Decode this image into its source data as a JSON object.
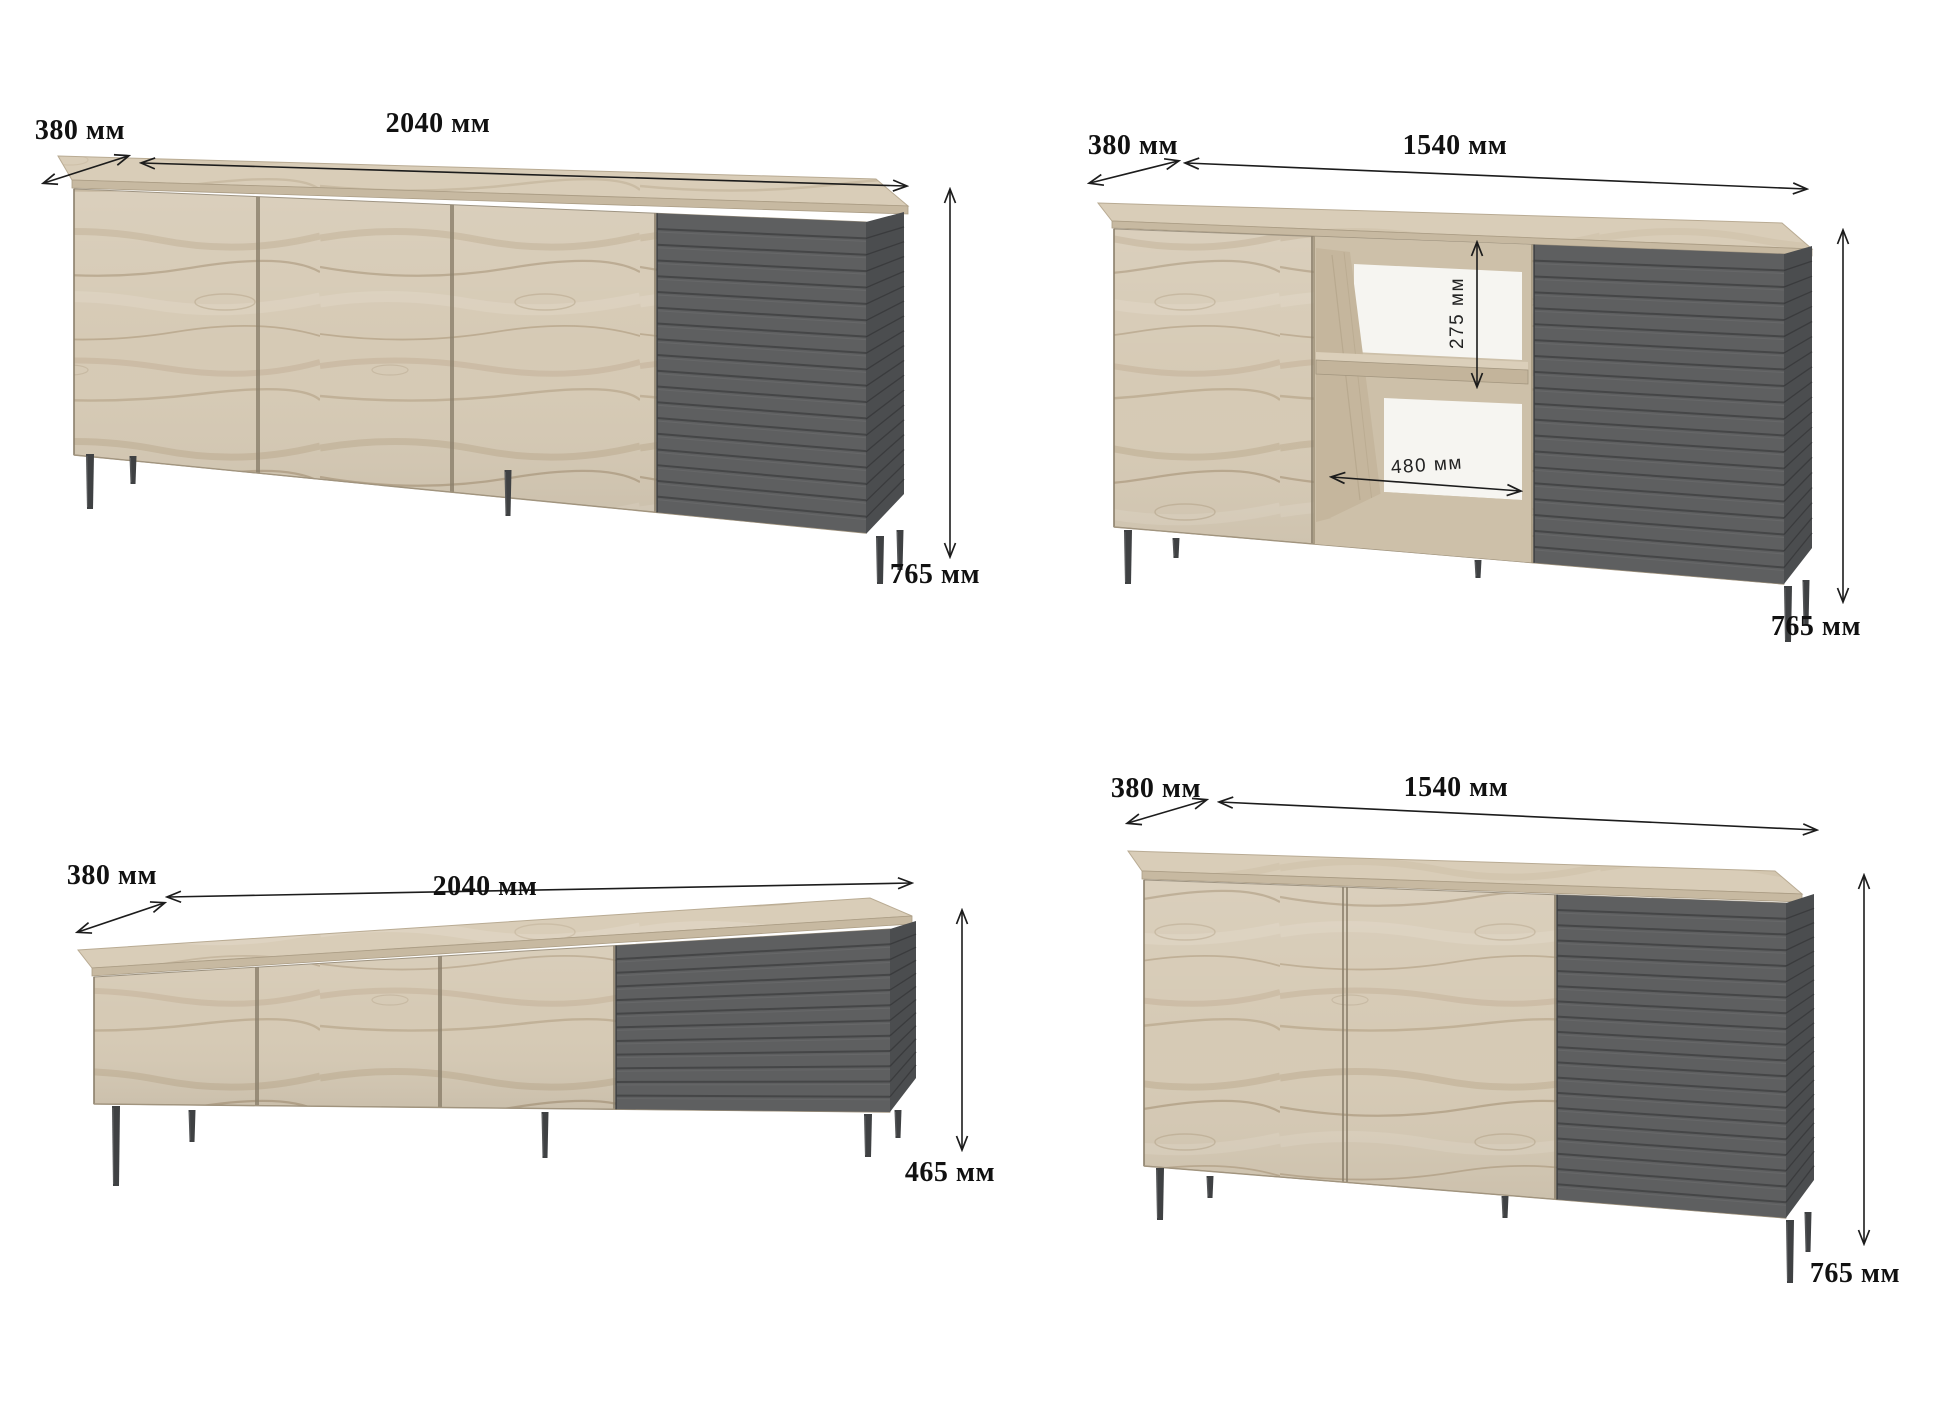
{
  "canvas": {
    "background": "#ffffff"
  },
  "colors": {
    "wood_base": "#d6cab5",
    "wood_grain_dark": "#b2a084",
    "wood_grain_mid": "#c2b197",
    "wood_grain_light": "#e0d6c6",
    "wood_top": "#d9cdb8",
    "wood_edge_strip": "#c7b9a1",
    "wood_interior": "#cdc0a9",
    "wood_interior_wall": "#c5b69d",
    "shelf_back_white": "#f6f5f1",
    "slat_face": "#5e5f60",
    "slat_gap": "#454647",
    "side_panel": "#4b4d4f",
    "side_panel_line": "#3a3b3d",
    "leg": "#3f4143",
    "dimension_line": "#1c1c1c",
    "label_color": "#111111"
  },
  "pieces": [
    {
      "id": "sideboard-2040-h765",
      "description": "wide sideboard, three wood doors, slatted dark section",
      "labels": {
        "depth": "380 мм",
        "width": "2040 мм",
        "height": "765 мм"
      }
    },
    {
      "id": "sideboard-1540-open-shelf-h765",
      "description": "sideboard with open shelf niche, wood door and slatted dark door",
      "labels": {
        "depth": "380 мм",
        "width": "1540 мм",
        "height": "765 мм",
        "shelf_height": "275 мм",
        "shelf_width": "480 мм"
      }
    },
    {
      "id": "tv-stand-2040-h465",
      "description": "low tv stand, three wood doors, slatted dark section",
      "labels": {
        "depth": "380 мм",
        "width": "2040 мм",
        "height": "465 мм"
      }
    },
    {
      "id": "sideboard-1540-h765",
      "description": "sideboard, two wood doors, slatted dark section",
      "labels": {
        "depth": "380 мм",
        "width": "1540 мм",
        "height": "765 мм"
      }
    }
  ]
}
